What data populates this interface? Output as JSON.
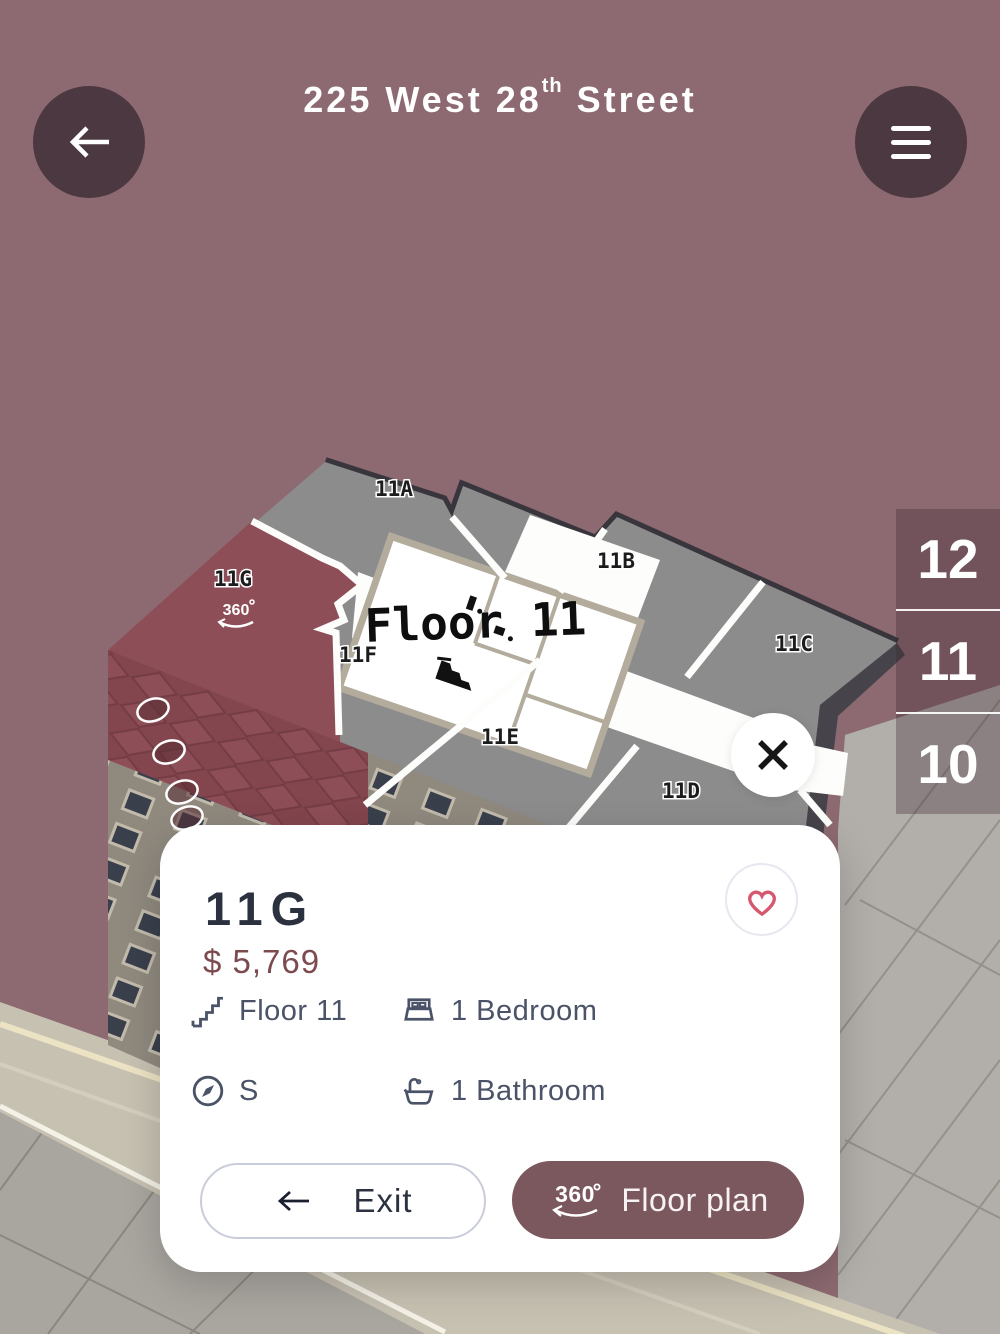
{
  "header": {
    "title": "225 West 28",
    "title_superscript": "th",
    "title_suffix": "Street",
    "back_icon": "arrow-left",
    "menu_icon": "hamburger"
  },
  "building": {
    "floor_label": "Floor 11",
    "badge_360": "360",
    "units": [
      {
        "id": "11A",
        "selected": false
      },
      {
        "id": "11B",
        "selected": false
      },
      {
        "id": "11C",
        "selected": false
      },
      {
        "id": "11D",
        "selected": false
      },
      {
        "id": "11E",
        "selected": false
      },
      {
        "id": "11F",
        "selected": false
      },
      {
        "id": "11G",
        "selected": true
      }
    ]
  },
  "floor_selector": {
    "floors": [
      "12",
      "11",
      "10"
    ],
    "current": "11"
  },
  "close_button": {
    "icon": "x"
  },
  "unit_card": {
    "unit": "11G",
    "price": "$ 5,769",
    "favorite_icon": "heart",
    "features": [
      {
        "icon": "stairs",
        "label": "Floor 11"
      },
      {
        "icon": "bed",
        "label": "1 Bedroom"
      },
      {
        "icon": "compass",
        "label": "S"
      },
      {
        "icon": "bath",
        "label": "1 Bathroom"
      }
    ],
    "exit_button": {
      "icon": "arrow-left",
      "label": "Exit"
    },
    "floor_plan_button": {
      "badge": "360",
      "label": "Floor plan"
    }
  },
  "colors": {
    "background": "#8D6A71",
    "header_button": "#4B3840",
    "unit_highlight": "#8E4E57",
    "roof_gray": "#8C8C8C",
    "accent_button": "#7B575E",
    "heart": "#D5586E",
    "price": "#7C4B50",
    "text_dark": "#2C3140",
    "feature_text": "#4A5368"
  }
}
